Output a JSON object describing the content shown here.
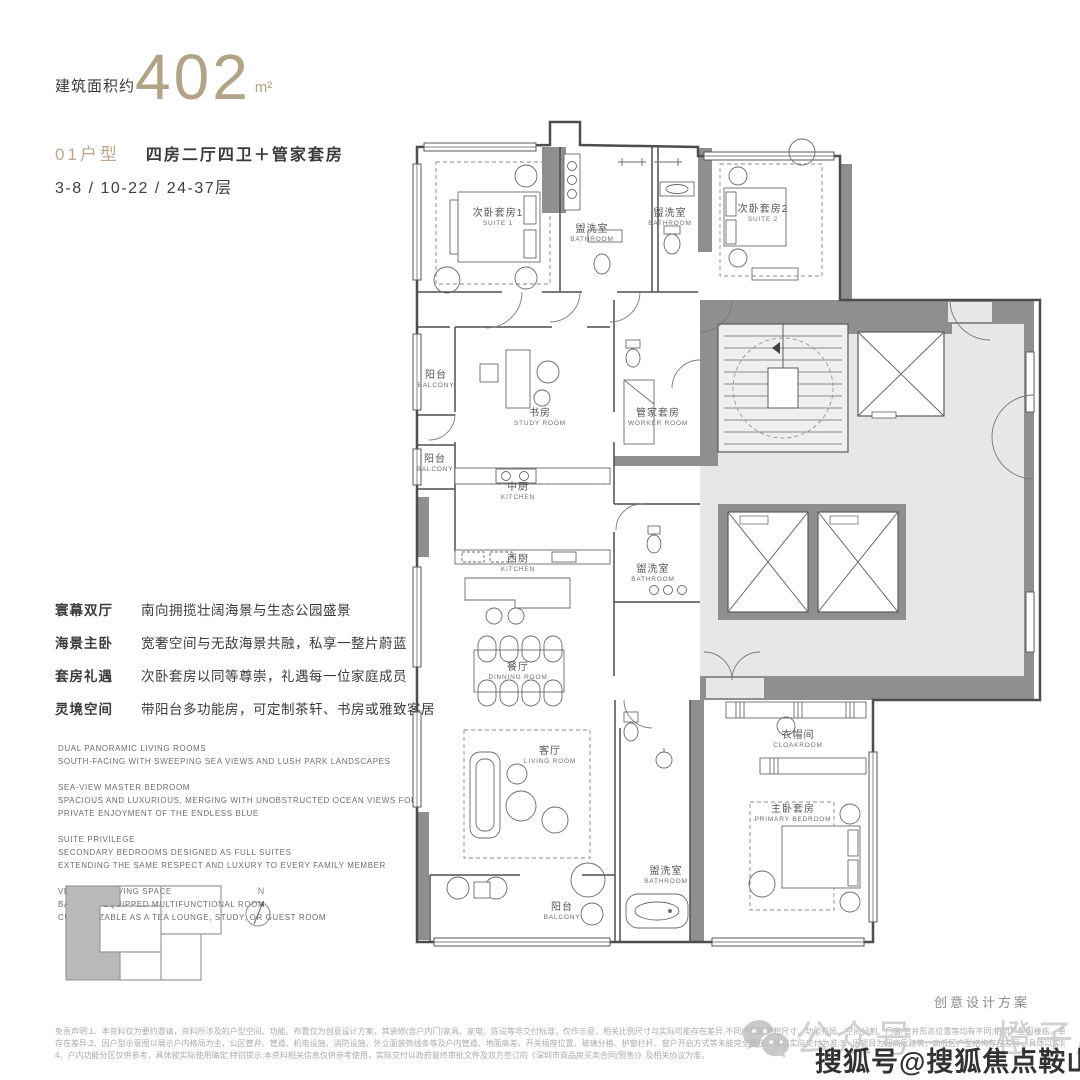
{
  "header": {
    "area_label": "建筑面积约",
    "area_value": "402",
    "area_unit": "m²",
    "unit_type": "01户型",
    "unit_desc": "四房二厅四卫＋管家套房",
    "floors": "3-8 / 10-22 / 24-37层"
  },
  "features": [
    {
      "term": "寰幕双厅",
      "desc": "南向拥揽壮阔海景与生态公园盛景"
    },
    {
      "term": "海景主卧",
      "desc": "宽奢空间与无敌海景共融，私享一整片蔚蓝"
    },
    {
      "term": "套房礼遇",
      "desc": "次卧套房以同等尊崇，礼遇每一位家庭成员"
    },
    {
      "term": "灵境空间",
      "desc": "带阳台多功能房，可定制茶轩、书房或雅致客居"
    }
  ],
  "features_en": [
    {
      "lines": [
        "DUAL PANORAMIC LIVING ROOMS",
        "SOUTH-FACING WITH SWEEPING SEA VIEWS AND LUSH PARK LANDSCAPES"
      ]
    },
    {
      "lines": [
        "SEA-VIEW MASTER BEDROOM",
        "SPACIOUS AND LUXURIOUS, MERGING WITH UNOBSTRUCTED OCEAN VIEWS FOR",
        "PRIVATE ENJOYMENT OF THE ENDLESS BLUE"
      ]
    },
    {
      "lines": [
        "SUITE PRIVILEGE",
        "SECONDARY BEDROOMS DESIGNED AS FULL SUITES",
        "EXTENDING THE SAME RESPECT AND LUXURY TO EVERY FAMILY MEMBER"
      ]
    },
    {
      "lines": [
        "VERSATILE LIVING SPACE",
        "BALCONY-EQUIPPED MULTIFUNCTIONAL ROOM",
        "CUSTOMIZABLE AS A TEA LOUNGE, STUDY, OR GUEST ROOM"
      ]
    }
  ],
  "floor_plan": {
    "rooms": [
      {
        "zh": "次卧套房1",
        "en": "SUITE 1",
        "x": 96,
        "y": 106
      },
      {
        "zh": "盥洗室",
        "en": "BATHROOM",
        "x": 190,
        "y": 122
      },
      {
        "zh": "盥洗室",
        "en": "BATHROOM",
        "x": 268,
        "y": 106
      },
      {
        "zh": "次卧套房2",
        "en": "SUITE 2",
        "x": 361,
        "y": 102
      },
      {
        "zh": "阳台",
        "en": "BALCONY",
        "x": 34,
        "y": 268
      },
      {
        "zh": "书房",
        "en": "STUDY ROOM",
        "x": 138,
        "y": 306
      },
      {
        "zh": "管家套房",
        "en": "WORKER ROOM",
        "x": 256,
        "y": 306
      },
      {
        "zh": "阳台",
        "en": "BALCONY",
        "x": 33,
        "y": 352
      },
      {
        "zh": "中厨",
        "en": "KITCHEN",
        "x": 116,
        "y": 380
      },
      {
        "zh": "西厨",
        "en": "KITCHEN",
        "x": 116,
        "y": 452
      },
      {
        "zh": "盥洗室",
        "en": "BATHROOM",
        "x": 251,
        "y": 462
      },
      {
        "zh": "餐厅",
        "en": "DINNING ROOM",
        "x": 116,
        "y": 560
      },
      {
        "zh": "客厅",
        "en": "LIVING ROOM",
        "x": 148,
        "y": 644
      },
      {
        "zh": "衣帽间",
        "en": "CLOAKROOM",
        "x": 396,
        "y": 628
      },
      {
        "zh": "主卧套房",
        "en": "PRIMARY BEDROOM",
        "x": 391,
        "y": 702
      },
      {
        "zh": "盥洗室",
        "en": "BATHROOM",
        "x": 264,
        "y": 764
      },
      {
        "zh": "阳台",
        "en": "BALCONY",
        "x": 160,
        "y": 800
      }
    ],
    "north_label": "N"
  },
  "footer": {
    "design_note": "创意设计方案",
    "disclaimer_lines": [
      "免责声明:1、本资料仅为要约邀请，资料所涉及的户型空间、功能、布置仅为创意设计方案，其装修(含户内门)家具、家电、陈设等非交付标准，仅作示意，相关比例尺寸与实际可能存在差异;不同户型的面积尺寸、功能布局、空间分割、门窗/管井形态位置等均有不同;相同户型因楼栋、单元、楼层等不同，其结构、面积尺寸亦可能",
      "存在差异;2、因户型示意图以展示户内格局为主，公区管井、管道、机电设施、消防设施、外立面装饰线条等及户内管道、地面高差、开关插座位置、玻璃分格、护窗栏杆、窗户开启方式等未能完全展示，请以实际交付为准;3、因项目为超高层建筑，高低区户型结构存在差异，具体以实际交付为准;",
      "4、户内功能分区仅供参考，具体按实际使用确定;特别提示:本资料相关信息仅供参考使用，实际交付以政府最终审批文件及双方签订的《深圳市商品房买卖合同(预售)》及相关协议为准。"
    ]
  },
  "watermarks": {
    "light": "公众号——橙子房讯",
    "dark": "搜狐号@搜狐焦点鞍山站"
  },
  "colors": {
    "accent": "#b3a386",
    "wall": "#4e4e4e",
    "poche": "#8f8f8f",
    "core_fill": "#e7e7e6"
  }
}
